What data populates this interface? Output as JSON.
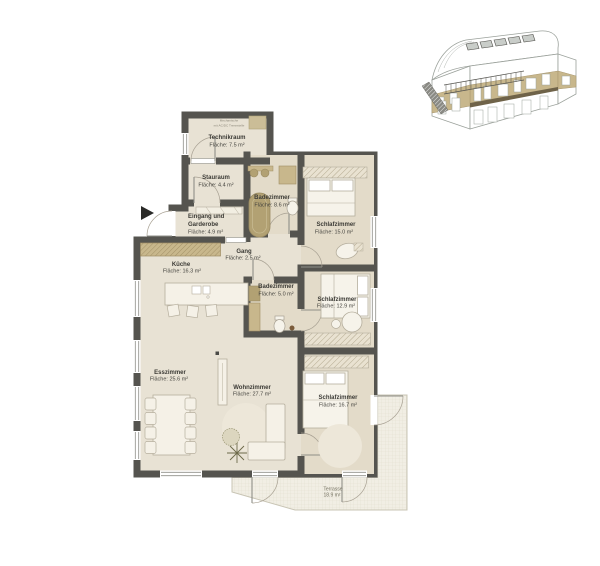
{
  "plan": {
    "colors": {
      "wall": "#55544f",
      "floor_main": "#e8e2d4",
      "floor_rooms": "#e3dbc9",
      "fixture_tan": "#b2a173",
      "counter_tan": "#c8b78c",
      "furniture_fill": "#f5f1e7",
      "furniture_stroke": "#b5ae9d",
      "rug": "#ede7d9",
      "terrace_fill": "#f1eee4",
      "label_text": "#3b3a35"
    },
    "rooms": [
      {
        "id": "technikraum",
        "lines": [
          "Technikraum",
          "Fläche: 7.5 m²"
        ]
      },
      {
        "id": "stauraum",
        "lines": [
          "Stauraum",
          "Fläche: 4.4 m²"
        ]
      },
      {
        "id": "badezimmer-1",
        "lines": [
          "Badezimmer",
          "Fläche: 8.6 m²"
        ]
      },
      {
        "id": "eingang-garderobe",
        "lines": [
          "Eingang und",
          "Garderobe",
          "Fläche: 4.9 m²"
        ]
      },
      {
        "id": "schlafzimmer-1",
        "lines": [
          "Schlafzimmer",
          "Fläche: 15.0 m²"
        ]
      },
      {
        "id": "gang",
        "lines": [
          "Gang",
          "Fläche: 2.5 m²"
        ]
      },
      {
        "id": "kueche",
        "lines": [
          "Küche",
          "Fläche: 16.3 m²"
        ]
      },
      {
        "id": "badezimmer-2",
        "lines": [
          "Badezimmer",
          "Fläche: 5.0 m²"
        ]
      },
      {
        "id": "schlafzimmer-2",
        "lines": [
          "Schlafzimmer",
          "Fläche: 12.9 m²"
        ]
      },
      {
        "id": "esszimmer",
        "lines": [
          "Esszimmer",
          "Fläche: 25.6 m²"
        ]
      },
      {
        "id": "wohnzimmer",
        "lines": [
          "Wohnzimmer",
          "Fläche: 27.7 m²"
        ]
      },
      {
        "id": "schlafzimmer-3",
        "lines": [
          "Schlafzimmer",
          "Fläche: 16.7 m²"
        ]
      }
    ],
    "terrace": {
      "lines": [
        "Terrasse",
        "18.9 m²"
      ]
    },
    "technik_note": {
      "lines": [
        "Mechanische",
        "mit AC/DC Trennstelle"
      ]
    }
  }
}
